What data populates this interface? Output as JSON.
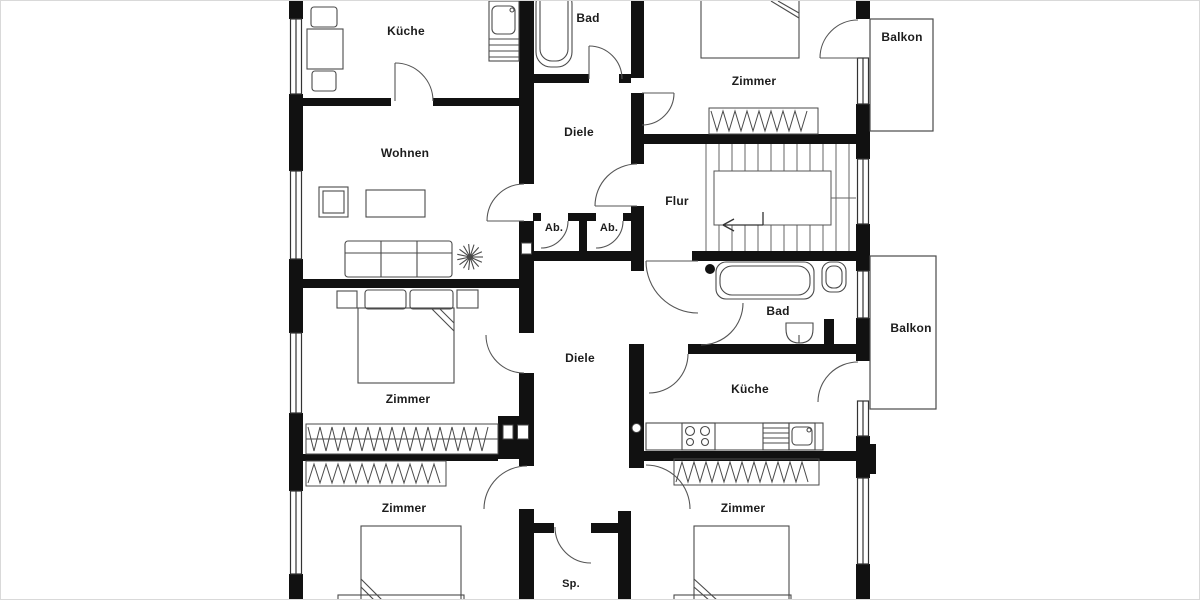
{
  "meta": {
    "type": "floor-plan",
    "language": "de"
  },
  "colors": {
    "background": "#ffffff",
    "wall": "#111111",
    "furniture_line": "#4a4a4a",
    "door_line": "#555555",
    "frame_border": "#d9d9d9"
  },
  "rooms": [
    {
      "id": "kueche-top",
      "label": "Küche"
    },
    {
      "id": "bad-top",
      "label": "Bad"
    },
    {
      "id": "zimmer-top-right",
      "label": "Zimmer"
    },
    {
      "id": "balkon-top",
      "label": "Balkon"
    },
    {
      "id": "wohnen",
      "label": "Wohnen"
    },
    {
      "id": "diele-top",
      "label": "Diele"
    },
    {
      "id": "flur",
      "label": "Flur"
    },
    {
      "id": "ab-left",
      "label": "Ab."
    },
    {
      "id": "ab-right",
      "label": "Ab."
    },
    {
      "id": "bad-middle",
      "label": "Bad"
    },
    {
      "id": "balkon-middle",
      "label": "Balkon"
    },
    {
      "id": "zimmer-mid-left",
      "label": "Zimmer"
    },
    {
      "id": "diele-bottom",
      "label": "Diele"
    },
    {
      "id": "kueche-bottom",
      "label": "Küche"
    },
    {
      "id": "zimmer-bottom-left",
      "label": "Zimmer"
    },
    {
      "id": "zimmer-bottom-right",
      "label": "Zimmer"
    },
    {
      "id": "speisekammer",
      "label": "Sp."
    }
  ]
}
